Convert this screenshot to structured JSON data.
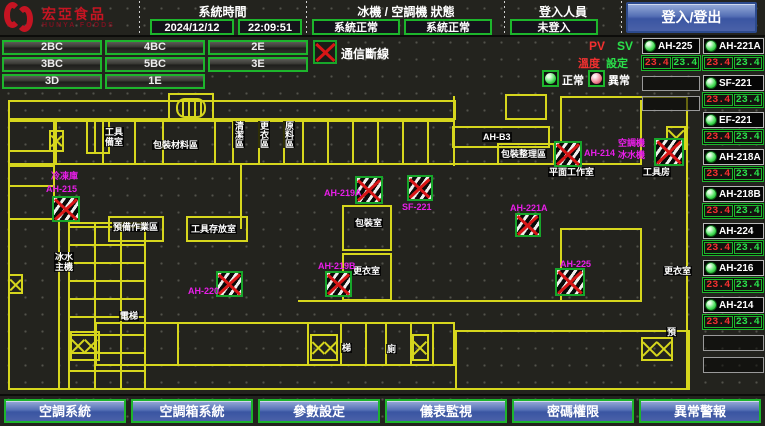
{
  "header": {
    "brand": {
      "name": "宏亞食品",
      "name_en": "HUNYA FOODS"
    },
    "system_time": {
      "label": "系統時間",
      "date": "2024/12/12",
      "time": "22:09:51"
    },
    "machine_status": {
      "label": "冰機 / 空調機 狀態",
      "chiller_status": "系統正常",
      "ahu_status": "系統正常"
    },
    "login": {
      "label": "登入人員",
      "user": "未登入",
      "button_label": "登入/登出"
    }
  },
  "zones": [
    {
      "label": "2BC",
      "col": 0,
      "row": 0
    },
    {
      "label": "4BC",
      "col": 1,
      "row": 0
    },
    {
      "label": "2E",
      "col": 2,
      "row": 0
    },
    {
      "label": "3BC",
      "col": 0,
      "row": 1
    },
    {
      "label": "5BC",
      "col": 1,
      "row": 1
    },
    {
      "label": "3E",
      "col": 2,
      "row": 1
    },
    {
      "label": "3D",
      "col": 0,
      "row": 2
    },
    {
      "label": "1E",
      "col": 1,
      "row": 2
    }
  ],
  "comm_alarm_label": "通信斷線",
  "legend": {
    "normal_label": "正常",
    "abnormal_label": "異常"
  },
  "panel": {
    "pv_header": "PV",
    "sv_header": "SV",
    "pv_row_label": "溫度",
    "sv_row_label": "設定",
    "pv_color": "#f23030",
    "sv_color": "#2ae04a",
    "left_column": [
      {
        "name": "AH-225",
        "pv": "23.4",
        "sv": "23.4",
        "status": "normal"
      }
    ],
    "right_column": [
      {
        "name": "AH-221A",
        "pv": "23.4",
        "sv": "23.4",
        "status": "normal"
      },
      {
        "name": "SF-221",
        "pv": "23.4",
        "sv": "23.4",
        "status": "normal"
      },
      {
        "name": "EF-221",
        "pv": "23.4",
        "sv": "23.4",
        "status": "normal"
      },
      {
        "name": "AH-218A",
        "pv": "23.4",
        "sv": "23.4",
        "status": "normal"
      },
      {
        "name": "AH-218B",
        "pv": "23.4",
        "sv": "23.4",
        "status": "normal"
      },
      {
        "name": "AH-224",
        "pv": "23.4",
        "sv": "23.4",
        "status": "normal"
      },
      {
        "name": "AH-216",
        "pv": "23.4",
        "sv": "23.4",
        "status": "normal"
      },
      {
        "name": "AH-214",
        "pv": "23.4",
        "sv": "23.4",
        "status": "normal"
      }
    ]
  },
  "map": {
    "wall_color": "#d6d61d",
    "ahu_label_color": "#e81ee8",
    "ahu_fans": [
      {
        "name": "AH-215",
        "x": 52,
        "y": 196,
        "w": 28,
        "h": 26,
        "lx": 46,
        "ly": 184
      },
      {
        "name": "AH-220",
        "x": 216,
        "y": 271,
        "w": 27,
        "h": 26,
        "lx": 188,
        "ly": 286
      },
      {
        "name": "AH-219B",
        "x": 325,
        "y": 271,
        "w": 27,
        "h": 26,
        "lx": 318,
        "ly": 261
      },
      {
        "name": "AH-219A",
        "x": 355,
        "y": 176,
        "w": 28,
        "h": 28,
        "lx": 324,
        "ly": 188
      },
      {
        "name": "AH-221A",
        "x": 515,
        "y": 213,
        "w": 26,
        "h": 24,
        "lx": 510,
        "ly": 203
      },
      {
        "name": "AH-214",
        "x": 554,
        "y": 141,
        "w": 28,
        "h": 26,
        "lx": 584,
        "ly": 148
      },
      {
        "name": "AH-225",
        "x": 555,
        "y": 268,
        "w": 30,
        "h": 28,
        "lx": 560,
        "ly": 259
      },
      {
        "name": "SF-221",
        "x": 407,
        "y": 175,
        "w": 26,
        "h": 26,
        "lx": 402,
        "ly": 202
      },
      {
        "name": "",
        "x": 654,
        "y": 138,
        "w": 30,
        "h": 28,
        "lx": 0,
        "ly": 0
      }
    ],
    "room_labels": [
      {
        "text": "冷凍庫",
        "x": 50,
        "y": 171,
        "color": "magenta"
      },
      {
        "text": "空調機",
        "x": 617,
        "y": 138,
        "color": "magenta"
      },
      {
        "text": "冰水機",
        "x": 617,
        "y": 150,
        "color": "magenta"
      },
      {
        "text": "工具\n備室",
        "x": 104,
        "y": 127
      },
      {
        "text": "包裝材料區",
        "x": 152,
        "y": 140
      },
      {
        "text": "清潔區",
        "x": 233,
        "y": 121,
        "vertical": true
      },
      {
        "text": "更衣區",
        "x": 258,
        "y": 121,
        "vertical": true
      },
      {
        "text": "原料區",
        "x": 283,
        "y": 121,
        "vertical": true
      },
      {
        "text": "AH-B3",
        "x": 482,
        "y": 132
      },
      {
        "text": "包裝整理區",
        "x": 500,
        "y": 149
      },
      {
        "text": "平面工作室",
        "x": 548,
        "y": 167
      },
      {
        "text": "工具房",
        "x": 642,
        "y": 167
      },
      {
        "text": "預備作業區",
        "x": 112,
        "y": 222
      },
      {
        "text": "工具存放室",
        "x": 190,
        "y": 224
      },
      {
        "text": "包裝室",
        "x": 354,
        "y": 218
      },
      {
        "text": "更衣室",
        "x": 352,
        "y": 266
      },
      {
        "text": "更衣室",
        "x": 663,
        "y": 266
      },
      {
        "text": "冰水\n主機",
        "x": 54,
        "y": 252
      },
      {
        "text": "電梯",
        "x": 119,
        "y": 311
      },
      {
        "text": "梯",
        "x": 341,
        "y": 343
      },
      {
        "text": "廁",
        "x": 386,
        "y": 344
      },
      {
        "text": "預",
        "x": 666,
        "y": 327
      }
    ],
    "x_boxes": [
      {
        "x": 70,
        "y": 331,
        "w": 30,
        "h": 30,
        "cells": 2
      },
      {
        "x": 310,
        "y": 334,
        "w": 28,
        "h": 27,
        "cells": 2
      },
      {
        "x": 412,
        "y": 334,
        "w": 17,
        "h": 27,
        "cells": 1
      },
      {
        "x": 666,
        "y": 126,
        "w": 20,
        "h": 24,
        "cells": 1
      },
      {
        "x": 641,
        "y": 337,
        "w": 32,
        "h": 24,
        "cells": 2
      },
      {
        "x": 8,
        "y": 274,
        "w": 15,
        "h": 20,
        "cells": 1
      },
      {
        "x": 49,
        "y": 130,
        "w": 15,
        "h": 22,
        "cells": 1
      }
    ]
  },
  "footer": {
    "buttons": [
      {
        "label": "空調系統",
        "name": "nav-hvac-system"
      },
      {
        "label": "空調箱系統",
        "name": "nav-ahu-system"
      },
      {
        "label": "參數設定",
        "name": "nav-parameter-settings"
      },
      {
        "label": "儀表監視",
        "name": "nav-meter-monitoring"
      },
      {
        "label": "密碼權限",
        "name": "nav-password-permission"
      },
      {
        "label": "異常警報",
        "name": "nav-alarm"
      }
    ]
  }
}
